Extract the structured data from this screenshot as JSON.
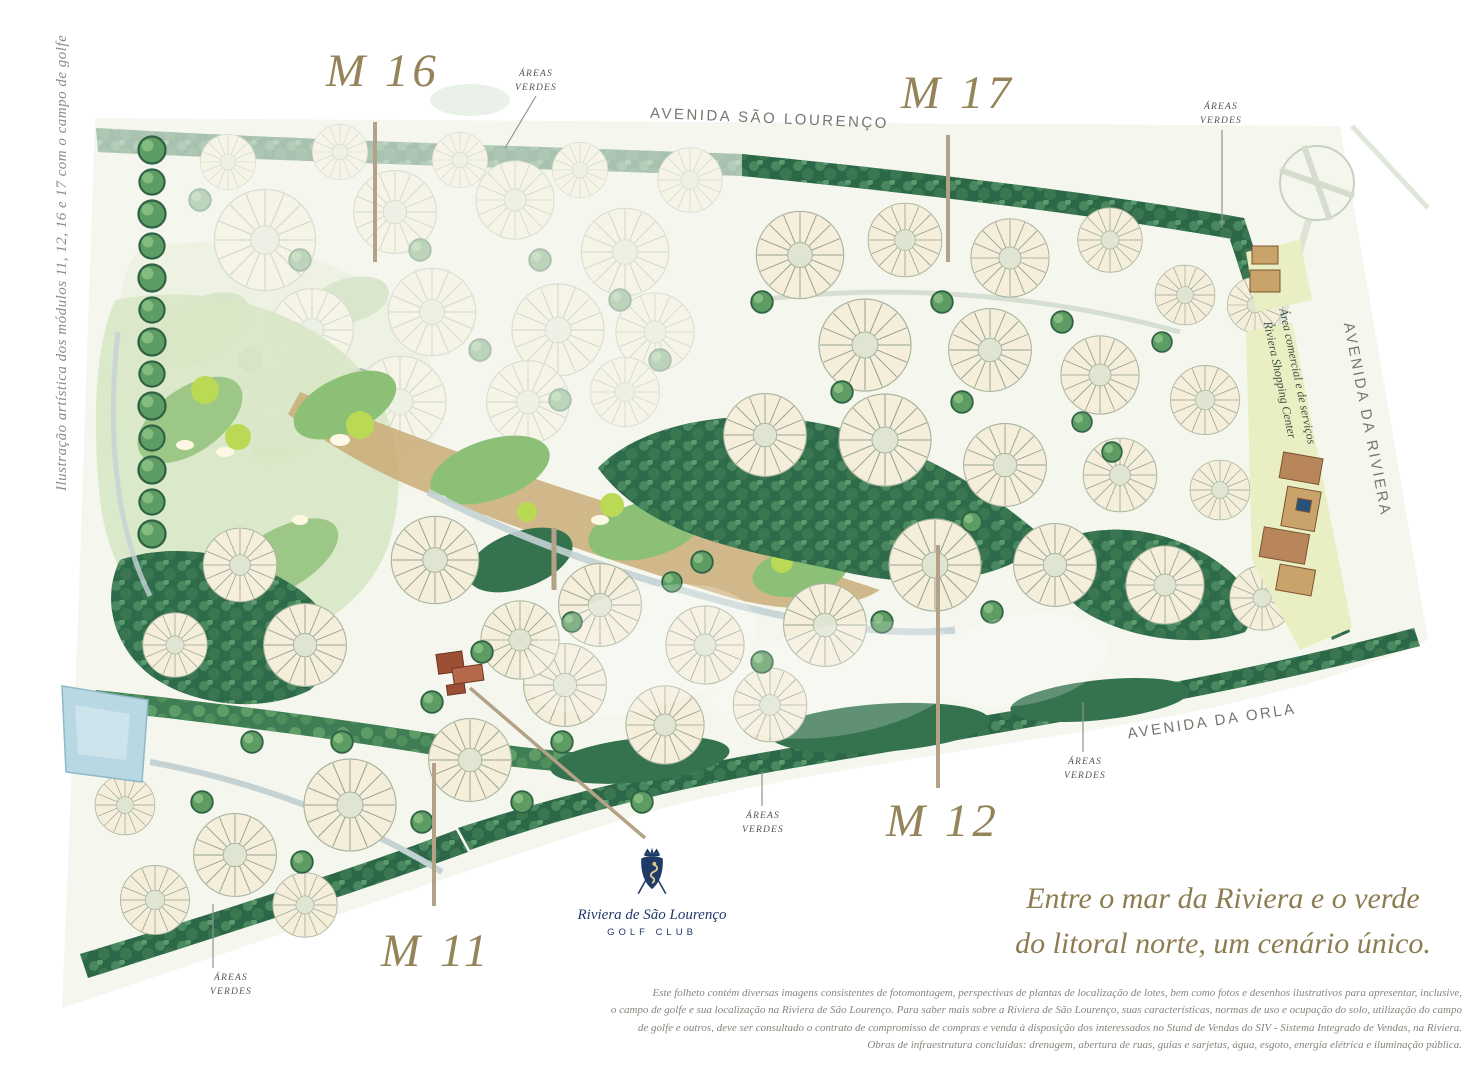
{
  "caption_left": "Ilustração artística dos módulos 11, 12, 16 e 17 com o campo de golfe",
  "modules": {
    "m16": "M 16",
    "m17": "M 17",
    "m12": "M 12",
    "m11": "M 11"
  },
  "streets": {
    "sao_lourenco": "AVENIDA SÃO LOURENÇO",
    "da_riviera": "AVENIDA DA RIVIERA",
    "da_orla": "AVENIDA DA ORLA"
  },
  "green_area_label": {
    "line1": "ÁREAS",
    "line2": "VERDES"
  },
  "commercial_area": {
    "line1": "Área comercial e de serviços",
    "line2": "Riviera Shopping Center"
  },
  "golf_club_logo": {
    "name": "Riviera de São Lourenço",
    "type": "GOLF CLUB",
    "crest_icon": "crowned-seahorse-crest"
  },
  "tagline": {
    "line1": "Entre o mar da Riviera e o verde",
    "line2": "do litoral norte, um cenário único."
  },
  "disclaimer": {
    "line1": "Este folheto contém diversas imagens consistentes de fotomontagem, perspectivas de plantas de localização de lotes, bem como fotos e desenhos ilustrativos para apresentar, inclusive,",
    "line2": "o campo de golfe e sua localização na Riviera de São Lourenço. Para saber mais sobre a Riviera de São Lourenço, suas características, normas de uso e ocupação do solo, utilização do campo",
    "line3": "de golfe e outros, deve ser consultado o contrato de compromisso de compras e venda à disposição dos interessados no Stand de Vendas do SIV - Sistema Integrado de Vendas, na Riviera.",
    "line4": "Obras de infraestrutura concluídas: drenagem, abertura de ruas, guias e sarjetas, água, esgoto, energia elétrica e iluminação pública."
  },
  "colors": {
    "module_label_tan": "#95845a",
    "street_gray": "#74796f",
    "tagline_tan": "#8d7c52",
    "logo_navy": "#20386b",
    "leader_line_tan": "#b3a287",
    "forest_green": "#2e6b4a",
    "fairway_green": "#8cc077",
    "lot_cream": "#f4eeda",
    "lake_blue": "#b8d8e3"
  }
}
